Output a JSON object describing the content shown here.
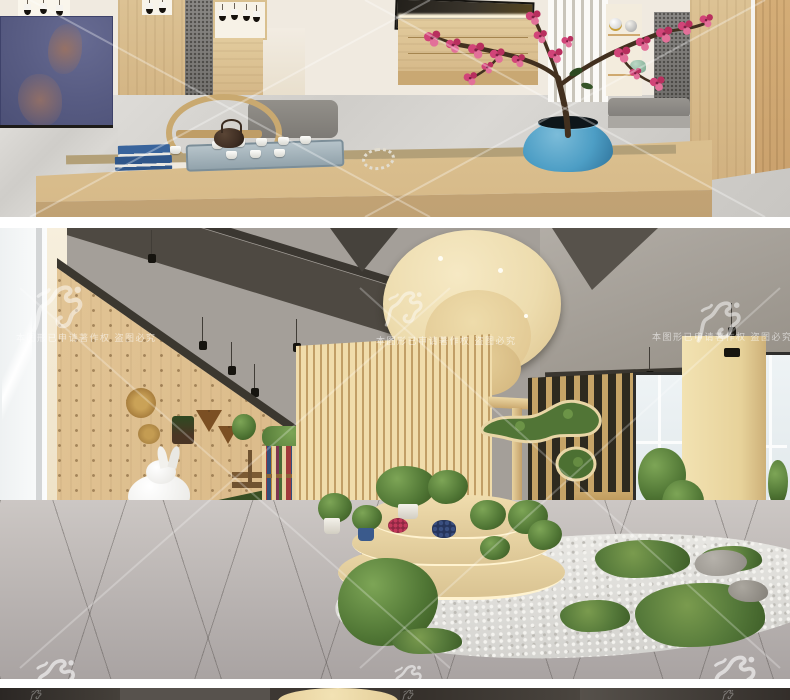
{
  "watermarks": {
    "copyright_text": "本图形已申请著作权 盗图必究",
    "dragon_icon": "dragon-seal-watermark",
    "cross_lines_icon": "diagonal-x-watermark",
    "color": "#ffffff"
  },
  "panels": {
    "top_render": {
      "subject": "tea room with wooden tea table, tea set, blue vase with plum blossoms"
    },
    "bottom_render": {
      "subject": "wood showroom with slatted pavilion, plant display, pebble garden, rabbit sculpture"
    },
    "partial_render": {
      "subject": "top edge of next interior render"
    }
  },
  "palette": {
    "background": "#ffffff",
    "wood_light": "#d9bc8c",
    "wood_slat": "#ecd7a4",
    "stone_dark": "#55504a",
    "screen_blue": "#5a5e85",
    "pot_blue": "#4d9ec5",
    "blossom_pink": "#cf3f73",
    "moss_green": "#567a3a",
    "grass_green": "#3f5a2c",
    "pebble_white": "#e6e5e1",
    "ceiling_gray": "#a49f99",
    "beam_dark": "#4e4942",
    "tile_gray": "#b5afae",
    "rabbit_white": "#f2f1ee",
    "disc_beige": "#eddcae",
    "cushion_gray": "#8a8886"
  }
}
